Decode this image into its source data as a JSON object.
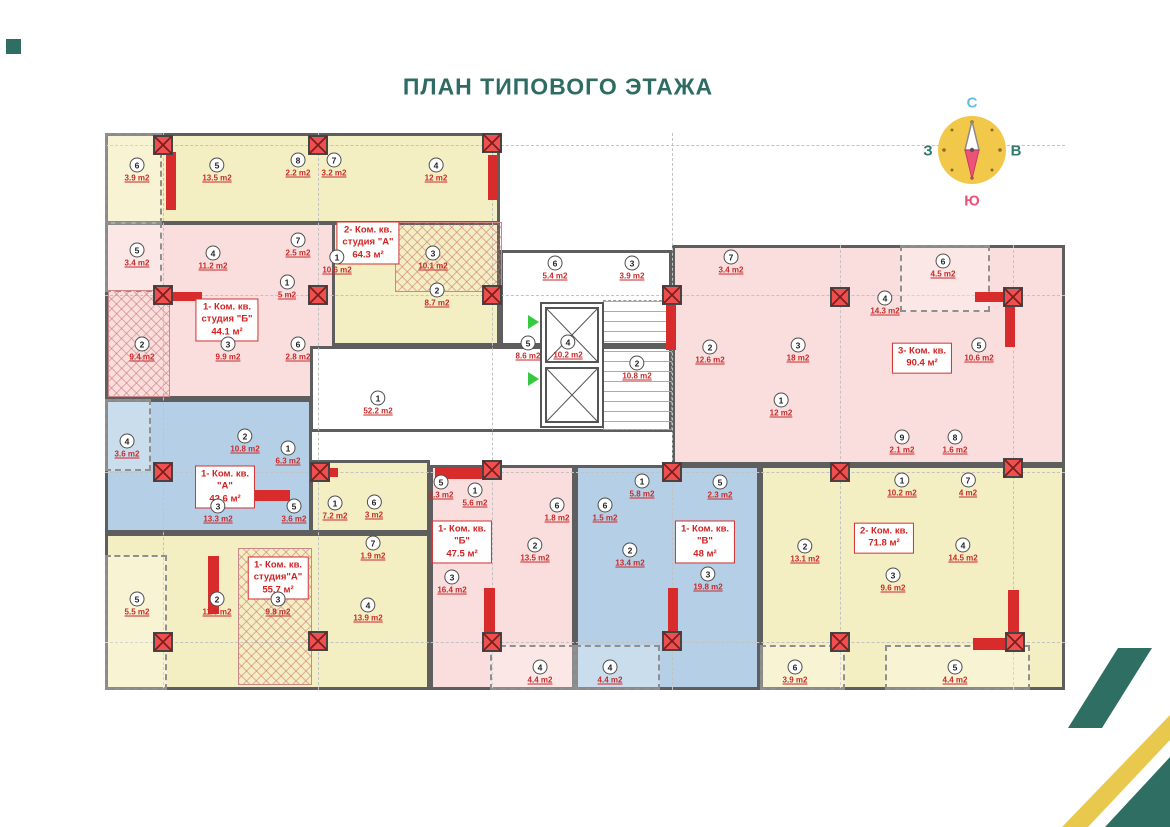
{
  "title": "ПЛАН ТИПОВОГО ЭТАЖА",
  "compass": {
    "n": "С",
    "s": "Ю",
    "w": "З",
    "e": "В"
  },
  "apartments": [
    {
      "label_line1": "2- Ком. кв.",
      "label_line2": "студия \"А\"",
      "label_area": "64.3 м²",
      "rooms": [
        {
          "num": "1",
          "area": "10.6 m2",
          "x": 337,
          "y": 262
        },
        {
          "num": "2",
          "area": "8.7 m2",
          "x": 437,
          "y": 295
        },
        {
          "num": "3",
          "area": "10.1 m2",
          "x": 433,
          "y": 258
        },
        {
          "num": "4",
          "area": "12 m2",
          "x": 436,
          "y": 170
        },
        {
          "num": "5",
          "area": "13.5 m2",
          "x": 217,
          "y": 170
        },
        {
          "num": "6",
          "area": "3.9 m2",
          "x": 137,
          "y": 170
        },
        {
          "num": "7",
          "area": "3.2 m2",
          "x": 334,
          "y": 165
        },
        {
          "num": "8",
          "area": "2.2 m2",
          "x": 298,
          "y": 165
        }
      ]
    },
    {
      "label_line1": "1- Ком. кв.",
      "label_line2": "студия \"Б\"",
      "label_area": "44.1 м²",
      "rooms": [
        {
          "num": "1",
          "area": "5 m2",
          "x": 287,
          "y": 287
        },
        {
          "num": "2",
          "area": "9.4 m2",
          "x": 142,
          "y": 349
        },
        {
          "num": "3",
          "area": "9.9 m2",
          "x": 228,
          "y": 349
        },
        {
          "num": "4",
          "area": "11.2 m2",
          "x": 213,
          "y": 258
        },
        {
          "num": "5",
          "area": "3.4 m2",
          "x": 137,
          "y": 255
        },
        {
          "num": "6",
          "area": "2.8 m2",
          "x": 298,
          "y": 349
        },
        {
          "num": "7",
          "area": "2.5 m2",
          "x": 298,
          "y": 245
        }
      ]
    },
    {
      "label_line1": "3- Ком. кв.",
      "label_line2": "",
      "label_area": "90.4 м²",
      "rooms": [
        {
          "num": "1",
          "area": "12 m2",
          "x": 781,
          "y": 405
        },
        {
          "num": "2",
          "area": "12.6 m2",
          "x": 710,
          "y": 352
        },
        {
          "num": "3",
          "area": "18 m2",
          "x": 798,
          "y": 350
        },
        {
          "num": "4",
          "area": "14.3 m2",
          "x": 885,
          "y": 303
        },
        {
          "num": "5",
          "area": "10.6 m2",
          "x": 979,
          "y": 350
        },
        {
          "num": "6",
          "area": "4.5 m2",
          "x": 943,
          "y": 266
        },
        {
          "num": "7",
          "area": "3.4 m2",
          "x": 731,
          "y": 262
        },
        {
          "num": "8",
          "area": "1.6 m2",
          "x": 955,
          "y": 442
        },
        {
          "num": "9",
          "area": "2.1 m2",
          "x": 902,
          "y": 442
        }
      ]
    },
    {
      "label_line1": "1- Ком. кв.",
      "label_line2": "\"А\"",
      "label_area": "42.6 м²",
      "rooms": [
        {
          "num": "1",
          "area": "6.3 m2",
          "x": 288,
          "y": 453
        },
        {
          "num": "2",
          "area": "10.8 m2",
          "x": 245,
          "y": 441
        },
        {
          "num": "3",
          "area": "13.3 m2",
          "x": 218,
          "y": 511
        },
        {
          "num": "4",
          "area": "3.6 m2",
          "x": 127,
          "y": 446
        },
        {
          "num": "5",
          "area": "3.6 m2",
          "x": 294,
          "y": 511
        }
      ]
    },
    {
      "label_line1": "1- Ком. кв.",
      "label_line2": "студия\"А\"",
      "label_area": "55.7 м²",
      "rooms": [
        {
          "num": "1",
          "area": "7.2 m2",
          "x": 335,
          "y": 508
        },
        {
          "num": "2",
          "area": "11.9 m2",
          "x": 217,
          "y": 604
        },
        {
          "num": "3",
          "area": "9.8 m2",
          "x": 278,
          "y": 604
        },
        {
          "num": "4",
          "area": "13.9 m2",
          "x": 368,
          "y": 610
        },
        {
          "num": "5",
          "area": "5.5 m2",
          "x": 137,
          "y": 604
        },
        {
          "num": "6",
          "area": "3 m2",
          "x": 374,
          "y": 507
        },
        {
          "num": "7",
          "area": "1.9 m2",
          "x": 373,
          "y": 548
        }
      ]
    },
    {
      "label_line1": "1- Ком. кв.",
      "label_line2": "\"Б\"",
      "label_area": "47.5 м²",
      "rooms": [
        {
          "num": "1",
          "area": "5.6 m2",
          "x": 475,
          "y": 495
        },
        {
          "num": "2",
          "area": "13.5 m2",
          "x": 535,
          "y": 550
        },
        {
          "num": "3",
          "area": "16.4 m2",
          "x": 452,
          "y": 582
        },
        {
          "num": "4",
          "area": "4.4 m2",
          "x": 540,
          "y": 672
        },
        {
          "num": "5",
          "area": "2.3 m2",
          "x": 441,
          "y": 487
        },
        {
          "num": "6",
          "area": "1.8 m2",
          "x": 557,
          "y": 510
        }
      ]
    },
    {
      "label_line1": "1- Ком. кв.",
      "label_line2": "\"В\"",
      "label_area": "48 м²",
      "rooms": [
        {
          "num": "1",
          "area": "5.8 m2",
          "x": 642,
          "y": 486
        },
        {
          "num": "2",
          "area": "13.4 m2",
          "x": 630,
          "y": 555
        },
        {
          "num": "3",
          "area": "19.8 m2",
          "x": 708,
          "y": 579
        },
        {
          "num": "4",
          "area": "4.4 m2",
          "x": 610,
          "y": 672
        },
        {
          "num": "5",
          "area": "2.3 m2",
          "x": 720,
          "y": 487
        },
        {
          "num": "6",
          "area": "1.5 m2",
          "x": 605,
          "y": 510
        }
      ]
    },
    {
      "label_line1": "2- Ком. кв.",
      "label_line2": "",
      "label_area": "71.8 м²",
      "rooms": [
        {
          "num": "1",
          "area": "10.2 m2",
          "x": 902,
          "y": 485
        },
        {
          "num": "2",
          "area": "13.1 m2",
          "x": 805,
          "y": 551
        },
        {
          "num": "3",
          "area": "9.6 m2",
          "x": 893,
          "y": 580
        },
        {
          "num": "4",
          "area": "14.5 m2",
          "x": 963,
          "y": 550
        },
        {
          "num": "5",
          "area": "4.4 m2",
          "x": 955,
          "y": 672
        },
        {
          "num": "6",
          "area": "3.9 m2",
          "x": 795,
          "y": 672
        },
        {
          "num": "7",
          "area": "4 m2",
          "x": 968,
          "y": 485
        }
      ]
    }
  ],
  "core_rooms": [
    {
      "num": "1",
      "area": "52.2 m2",
      "x": 378,
      "y": 403
    },
    {
      "num": "2",
      "area": "10.8 m2",
      "x": 637,
      "y": 368
    },
    {
      "num": "3",
      "area": "3.9 m2",
      "x": 632,
      "y": 268
    },
    {
      "num": "4",
      "area": "10.2 m2",
      "x": 568,
      "y": 347
    },
    {
      "num": "5",
      "area": "8.6 m2",
      "x": 528,
      "y": 348
    },
    {
      "num": "6",
      "area": "5.4 m2",
      "x": 555,
      "y": 268
    }
  ],
  "colors": {
    "accent_teal": "#2F6F63",
    "accent_yellow": "#E9C94D",
    "apartment_yellow": "#F4EFC3",
    "apartment_pink": "#F9DEDD",
    "apartment_blue": "#B5D0E6",
    "column_red": "#EF4F4F",
    "label_red": "#D22222",
    "wall_gray": "#5E5E5E",
    "compass_yellow": "#F2C84B",
    "compass_north_letter": "#5FBFE6",
    "compass_south_letter": "#EE5277",
    "compass_west_east_letter": "#2F7A6C",
    "title_teal": "#2E6B63",
    "elevator_arrow_green": "#35C93F"
  }
}
